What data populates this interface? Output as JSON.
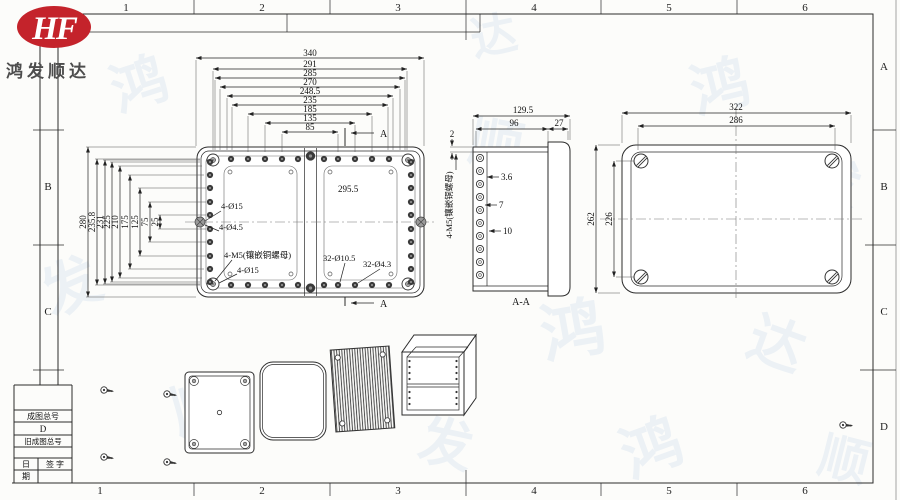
{
  "logo": {
    "monogram": "HF",
    "company": "鸿发顺达",
    "brand_color": "#c4232b"
  },
  "sheet": {
    "top_zone_numbers": [
      "1",
      "2",
      "3",
      "4",
      "5",
      "6"
    ],
    "bottom_zone_numbers": [
      "1",
      "2",
      "3",
      "4",
      "5",
      "6"
    ],
    "right_zone_letters": [
      "A",
      "B",
      "C",
      "D"
    ],
    "left_zone_letters": [
      "B",
      "C"
    ]
  },
  "front_view": {
    "top_dims": [
      "340",
      "291",
      "285",
      "270",
      "248.5",
      "235",
      "185",
      "135",
      "85"
    ],
    "left_dims": [
      "280",
      "235.8",
      "231",
      "225",
      "210",
      "175",
      "125",
      "75",
      "25"
    ],
    "labels": {
      "inner_width": "295.5",
      "corner_holes": "4-Ø15",
      "pilot_holes": "4-Ø4.5",
      "brass_nuts": "4-M5(镶嵌铜螺母)",
      "corner_holes2": "4-Ø15",
      "lid_holes": "32-Ø10.5",
      "screw_holes": "32-Ø4.3"
    },
    "section_letter": "A"
  },
  "section_view": {
    "top_dims": [
      "129.5",
      "96",
      "27"
    ],
    "wall_dim": "2",
    "side_label": "4-M5(镶嵌铜螺母)",
    "step_dims": [
      "3.6",
      "7",
      "10"
    ],
    "caption": "A-A"
  },
  "lid_view": {
    "width_dims": [
      "322",
      "286"
    ],
    "height_dims": [
      "262",
      "226"
    ]
  },
  "title_block": {
    "row_drawing_no_label": "成图总号",
    "row_drawing_no_value": "D",
    "row_old_no_label": "旧成图总号",
    "date_top": "日",
    "date_bottom": "期",
    "sign_label": "签 字"
  },
  "icons": {
    "assembly_screw": "side-view screw glyph (head circle + pointed shank)",
    "corner_fastener": "cross-recess screw head",
    "lid_fastener": "slotted screw head"
  }
}
